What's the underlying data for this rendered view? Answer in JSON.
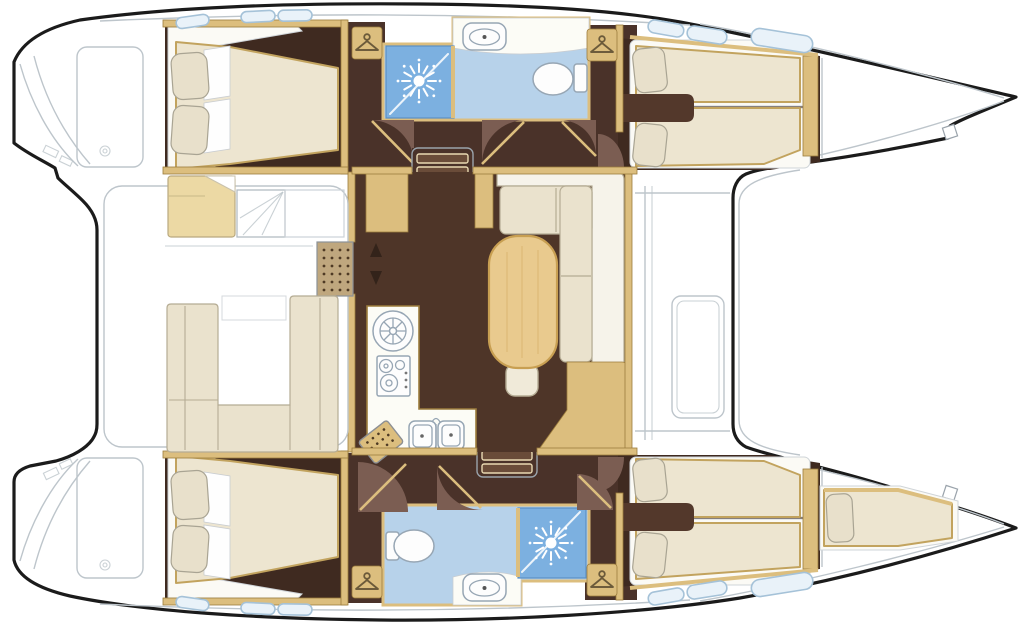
{
  "diagram": {
    "type": "floor-plan",
    "subject": "catamaran-yacht-deck-layout",
    "orientation": "bow-right",
    "hulls": 2
  },
  "colors": {
    "outline": "#1b1b1b",
    "deckline": "#bdc5cb",
    "floor_salon": "#4e3528",
    "floor_hull": "#3f2a20",
    "floor_corridor": "#4a3229",
    "door_disc": "#7b5d52",
    "wood": "#dcbe7e",
    "wood_dark": "#9c7c3c",
    "bench": "#ecd9a4",
    "grating": "#bfa77e",
    "grating_dot": "#4e3a24",
    "mattress": "#ede5d0",
    "bed_stroke": "#c2a35e",
    "pillow": "#e8e0cb",
    "pillow_stroke": "#a9a493",
    "cushion": "#eae2cd",
    "cushion_stroke": "#b5ac94",
    "cushion_light": "#f6f3ea",
    "table": "#e9ca8e",
    "table_stroke": "#c89f52",
    "table_grain": "#d9b36b",
    "stool": "#f0ead9",
    "bath": "#b7d2ea",
    "shower": "#7cb0e0",
    "shower_stroke": "#5a8fc4",
    "fixture_stroke": "#97a6b4",
    "counter": "#fcfcf6",
    "console": "#53382b",
    "steps_tread": "#6a4c39",
    "steps_edge": "#e9d9b2",
    "arrow": "#33231a",
    "window_fill": "#e9f2f9",
    "window_stroke": "#a5c2d8"
  },
  "rooms": [
    {
      "id": "cockpit",
      "label": "aft-cockpit-with-u-settee"
    },
    {
      "id": "salon",
      "label": "main-salon"
    },
    {
      "id": "galley",
      "label": "galley-with-stove-and-sinks"
    },
    {
      "id": "dinette",
      "label": "dinette-l-sofa-with-oval-table"
    },
    {
      "id": "cabin-port-aft",
      "label": "port-aft-double-cabin"
    },
    {
      "id": "bath-port",
      "label": "port-bathroom-shower-toilet-sink"
    },
    {
      "id": "cabin-port-fwd",
      "label": "port-forward-twin-berth-cabin"
    },
    {
      "id": "cabin-stbd-aft",
      "label": "starboard-aft-double-cabin"
    },
    {
      "id": "bath-stbd",
      "label": "starboard-bathroom-toilet-shower-sink"
    },
    {
      "id": "cabin-stbd-fwd",
      "label": "starboard-forward-twin-berth-cabin"
    },
    {
      "id": "forepeak",
      "label": "starboard-forepeak-single-berth"
    },
    {
      "id": "foredeck",
      "label": "foredeck-between-hulls"
    }
  ],
  "fixtures": {
    "shower_icon": "sunburst-shower-spray",
    "hanger_icon": "clothes-hanger",
    "toilet_icon": "toilet-bowl-with-tank",
    "bath_sink_icon": "vanity-basin",
    "round_sink_icon": "round-galley-basin",
    "stove_icon": "gas-stove-two-burners",
    "double_sink_icon": "double-galley-sink",
    "stairs_icon": "companionway-steps",
    "table_icon": "oval-salon-table",
    "grating_icon": "cockpit-grating",
    "arrows_icon": "sliding-door-arrows",
    "counts": {
      "hangers": 4,
      "showers": 2,
      "toilets": 2,
      "stair_flights": 2,
      "double_beds": 2,
      "twin_berths": 4,
      "forepeak_berths": 1
    }
  }
}
